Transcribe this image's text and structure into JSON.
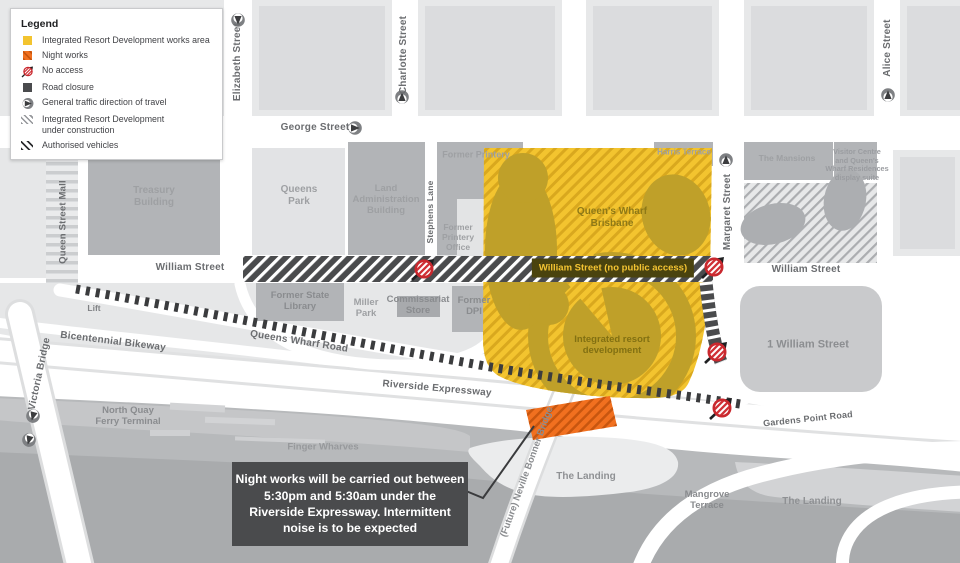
{
  "legend": {
    "title": "Legend",
    "items": [
      {
        "label": "Integrated Resort Development works area"
      },
      {
        "label": "Night works"
      },
      {
        "label": "No access"
      },
      {
        "label": "Road closure"
      },
      {
        "label": "General traffic direction of travel"
      },
      {
        "label": "Integrated Resort Development\nunder construction"
      },
      {
        "label": "Authorised vehicles"
      }
    ]
  },
  "streets": {
    "george": "George Street",
    "elizabeth": "Elizabeth Street",
    "charlotte": "Charlotte Street",
    "alice": "Alice Street",
    "queen_street_mall": "Queen Street Mall",
    "stephens_lane": "Stephens Lane",
    "margaret": "Margaret Street",
    "william_left": "William Street",
    "william_right": "William Street",
    "william_closed": "William Street (no public access)",
    "queens_wharf_road": "Queens Wharf Road",
    "bicentennial_bikeway": "Bicentennial Bikeway",
    "victoria_bridge": "Victoria Bridge",
    "riverside_expressway": "Riverside Expressway",
    "gardens_point_road": "Gardens Point Road",
    "neville_bonner_bridge": "(Future) Neville Bonner Bridge"
  },
  "places": {
    "treasury": "Treasury\nBuilding",
    "queens_park": "Queens\nPark",
    "land_admin": "Land\nAdministration\nBuilding",
    "former_printery": "Former Printery",
    "former_printery_office": "Former\nPrintery\nOffice",
    "harris_terrace": "Harris Terrace",
    "mansions": "The Mansions",
    "visitor_centre": "Visitor Centre\nand Queen's\nWharf Residences\ndisplay suite",
    "queens_wharf_brisbane": "Queen's Wharf\nBrisbane",
    "integrated_resort": "Integrated resort\ndevelopment",
    "one_william": "1 William Street",
    "former_state_library": "Former State\nLibrary",
    "miller_park": "Miller\nPark",
    "commissariat_store": "Commissariat\nStore",
    "former_dpi": "Former\nDPI",
    "lift": "Lift",
    "north_quay": "North Quay\nFerry Terminal",
    "finger_wharves": "Finger Wharves",
    "landing_center": "The Landing",
    "mangrove_terrace": "Mangrove\nTerrace",
    "landing_right": "The Landing"
  },
  "callout": {
    "text": "Night works will be carried out between\n5:30pm and 5:30am under the\nRiverside Expressway. Intermittent\nnoise is to be expected"
  },
  "colors": {
    "works_area_yellow": "#F3C42F",
    "works_hatch": "#D9A81E",
    "under_construction_building": "#BFA029",
    "night_works_orange": "#F1701F",
    "night_works_hatch": "#C8560F",
    "road_closure_grey": "#4A4B4D",
    "no_access_red": "#C9282E",
    "building_grey": "#B2B4B7",
    "river_bank_grey": "#B7B9BB"
  }
}
